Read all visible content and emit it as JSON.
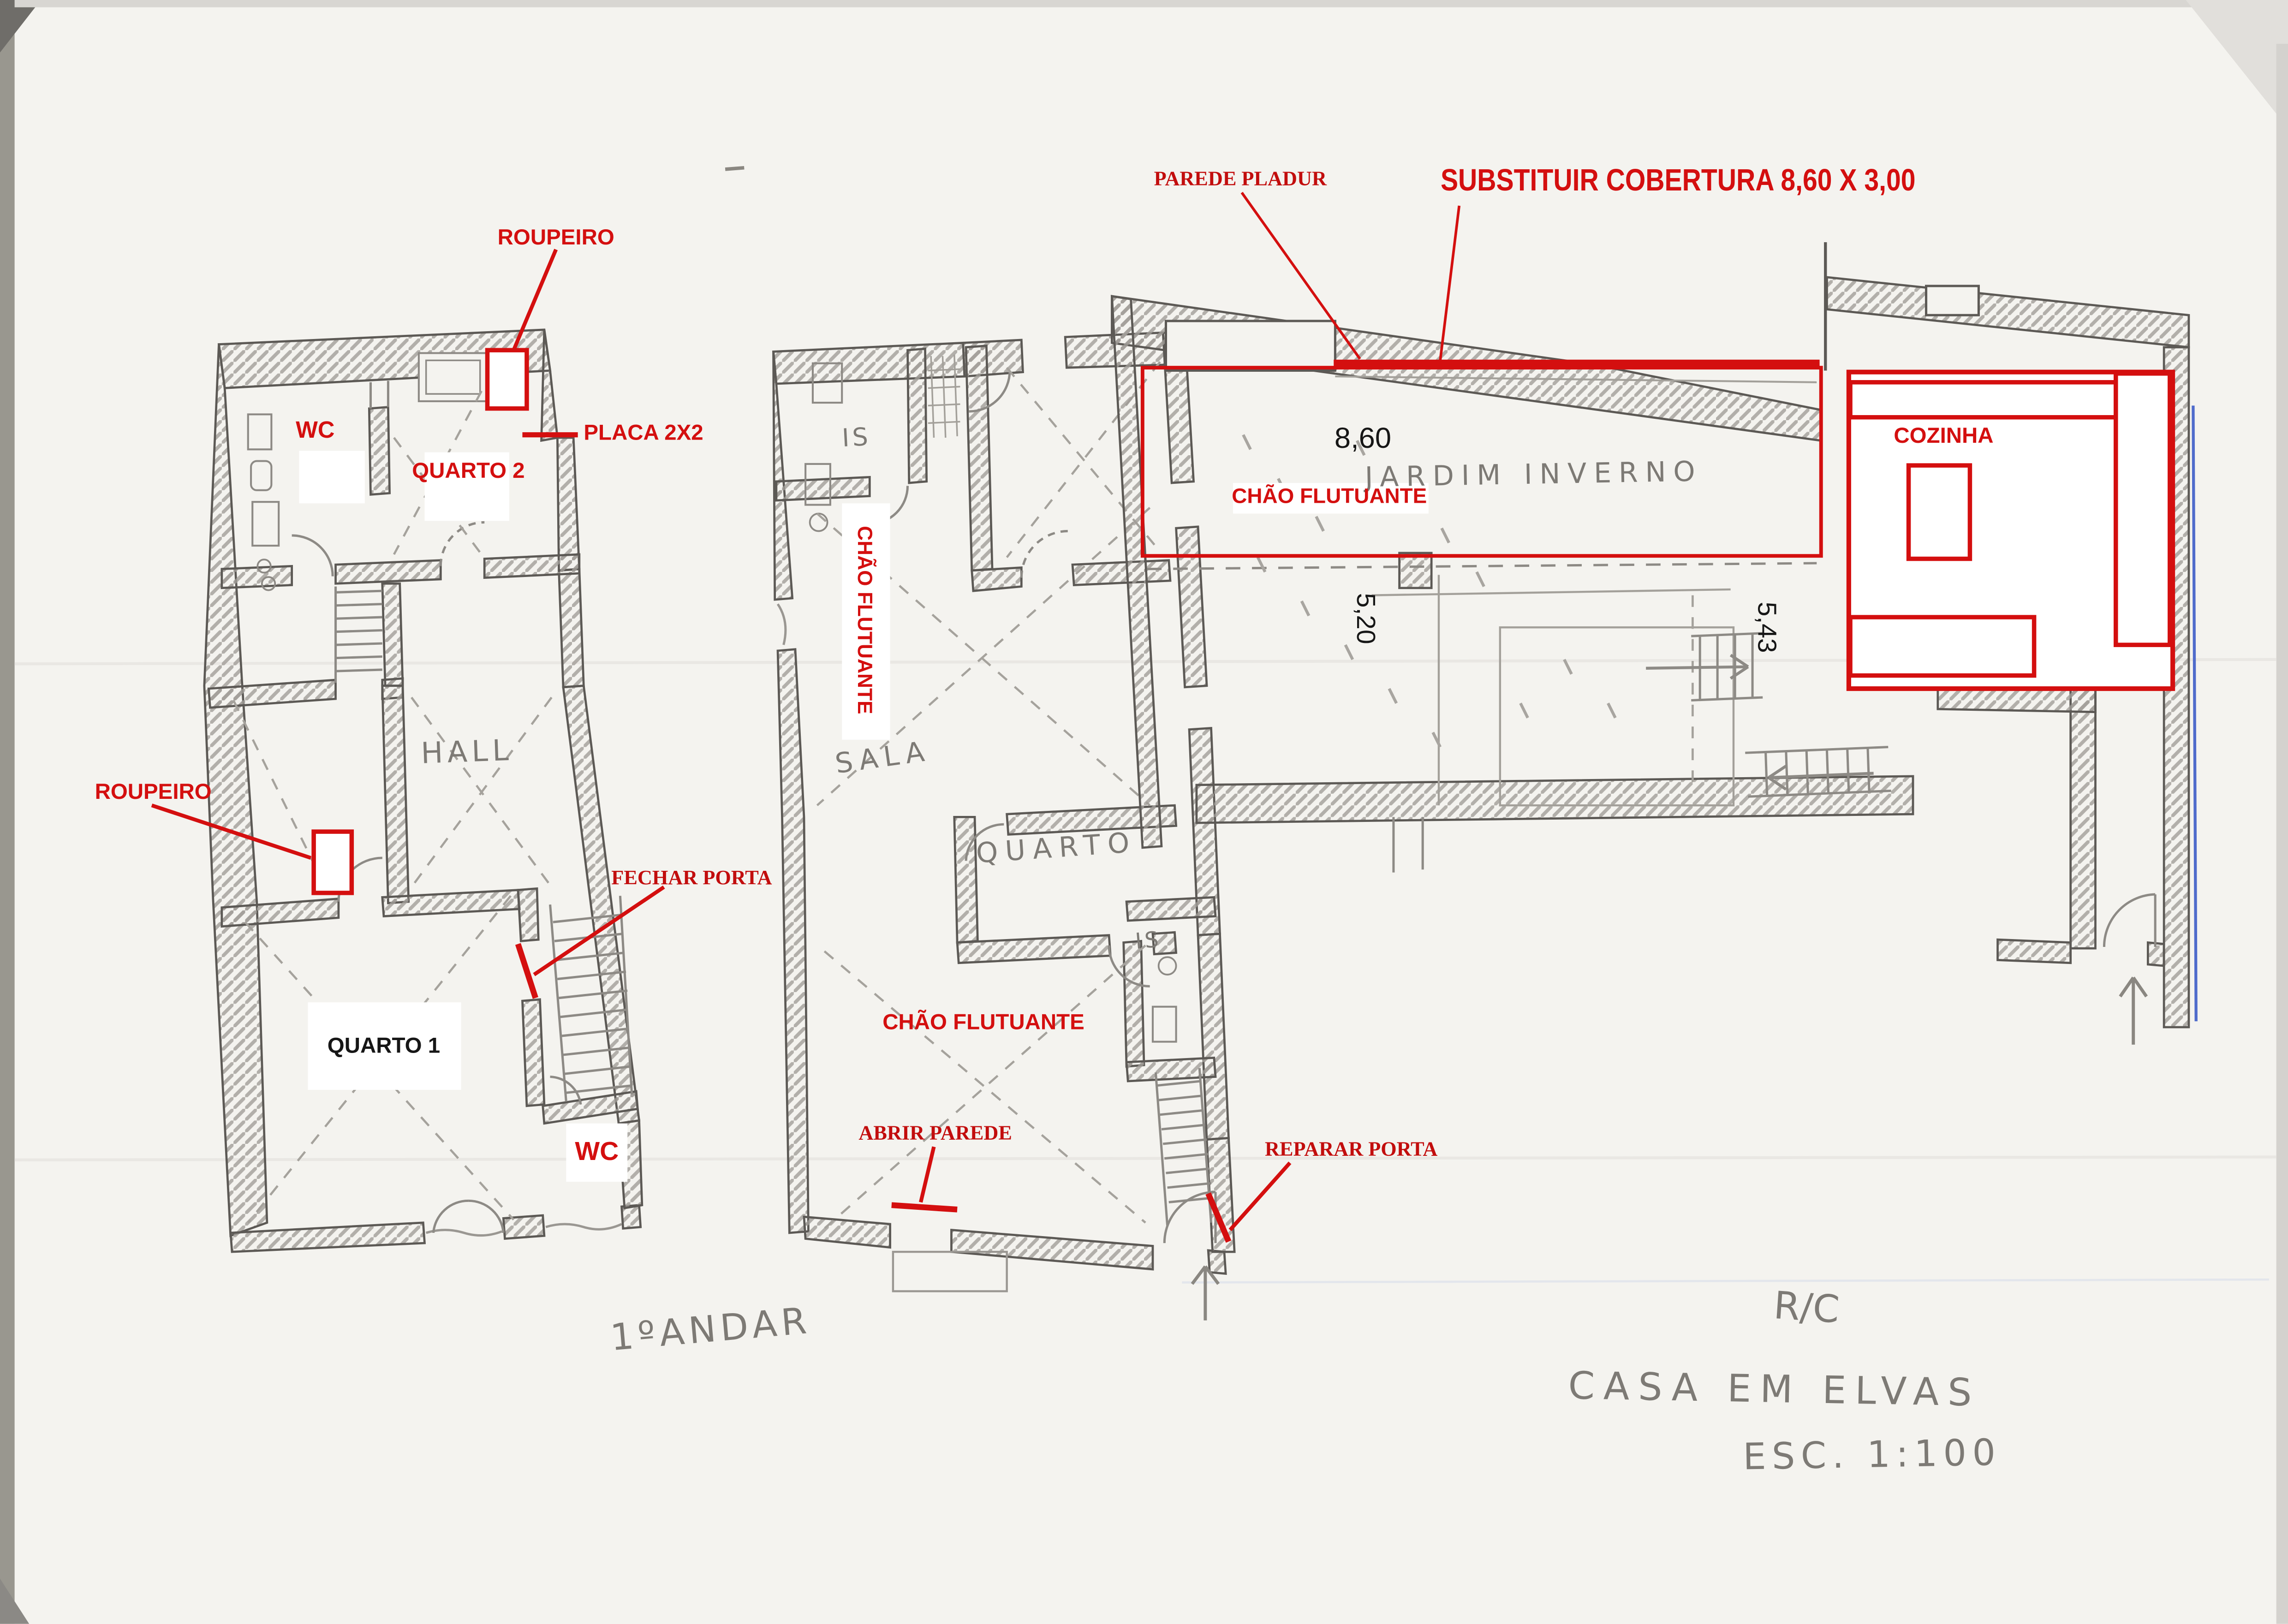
{
  "colors": {
    "annotation_red": "#d40f0f",
    "typed_black": "#161616",
    "pencil_gray": "#7d7a75",
    "pen_blue": "#4f6bcb",
    "paper": "#f4f3ef"
  },
  "floor1": {
    "name": "1ºANDAR",
    "rooms": {
      "wc_top": "WC",
      "quarto2": "QUARTO 2",
      "hall": "HALL",
      "quarto1": "QUARTO 1",
      "wc_bottom": "WC"
    },
    "annotations": {
      "roupeiro_top": "ROUPEIRO",
      "placa": "PLACA 2X2",
      "roupeiro_left": "ROUPEIRO",
      "fechar_porta": "FECHAR PORTA"
    }
  },
  "floor0": {
    "name": "R/C",
    "rooms": {
      "is_top": "IS",
      "sala": "SALA",
      "quarto": "QUARTO",
      "is_mid": "IS",
      "jardim_inverno": "JARDIM INVERNO",
      "cozinha": "COZINHA"
    },
    "annotations": {
      "parede_pladur": "PAREDE PLADUR",
      "substituir_cobertura": "SUBSTITUIR COBERTURA 8,60 X 3,00",
      "chao_flutuante_sala": "CHÃO FLUTUANTE",
      "chao_flutuante_jardim": "CHÃO FLUTUANTE",
      "chao_flutuante_inferior": "CHÃO FLUTUANTE",
      "abrir_parede": "ABRIR PAREDE",
      "reparar_porta": "REPARAR PORTA"
    },
    "dimensions": {
      "largura": "8,60",
      "altura_esquerda": "5,20",
      "altura_direita": "5,43"
    }
  },
  "titleblock": {
    "project": "CASA EM ELVAS",
    "scale": "ESC. 1:100"
  }
}
